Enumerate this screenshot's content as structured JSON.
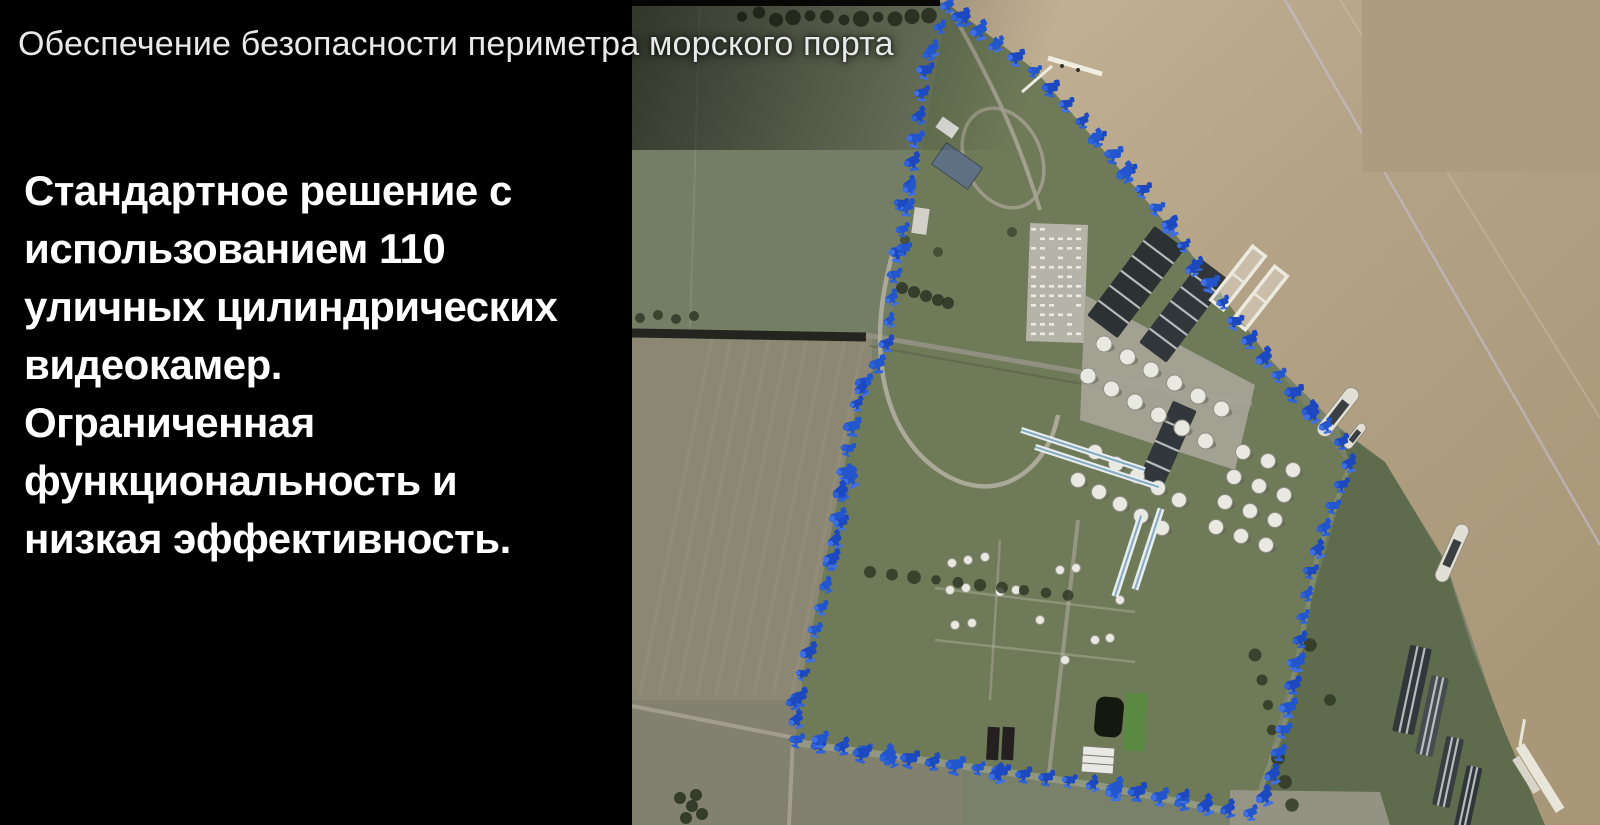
{
  "slide": {
    "title": "Обеспечение безопасности периметра морского порта",
    "body": "Стандартное решение с\nиспользованием 110\nуличных цилиндрических\nвидеокамер.\nОграниченная\nфункциональность и\nнизкая эффективность."
  },
  "map": {
    "type": "satellite-aerial-view",
    "subject": "seaport-industrial-facility-with-camera-perimeter",
    "perimeter": {
      "marker_icon": "cctv-camera-icon",
      "marker_color_dark": "#1c49c0",
      "marker_color_light": "#3f6fe0",
      "spacing_px": 23,
      "points": [
        [
          948,
          4
        ],
        [
          926,
          68
        ],
        [
          916,
          138
        ],
        [
          906,
          212
        ],
        [
          894,
          280
        ],
        [
          886,
          352
        ],
        [
          860,
          388
        ],
        [
          846,
          462
        ],
        [
          836,
          535
        ],
        [
          822,
          606
        ],
        [
          803,
          674
        ],
        [
          796,
          722
        ],
        [
          794,
          738
        ],
        [
          806,
          742
        ],
        [
          850,
          746
        ],
        [
          900,
          756
        ],
        [
          950,
          763
        ],
        [
          1013,
          772
        ],
        [
          1073,
          780
        ],
        [
          1127,
          788
        ],
        [
          1180,
          800
        ],
        [
          1230,
          808
        ],
        [
          1253,
          812
        ],
        [
          1262,
          802
        ],
        [
          1277,
          763
        ],
        [
          1287,
          716
        ],
        [
          1297,
          668
        ],
        [
          1303,
          620
        ],
        [
          1311,
          571
        ],
        [
          1324,
          528
        ],
        [
          1340,
          490
        ],
        [
          1350,
          464
        ],
        [
          1341,
          437
        ],
        [
          1318,
          418
        ],
        [
          1302,
          400
        ],
        [
          1268,
          361
        ],
        [
          1236,
          321
        ],
        [
          1205,
          273
        ],
        [
          1168,
          222
        ],
        [
          1130,
          170
        ],
        [
          1085,
          122
        ],
        [
          1035,
          70
        ],
        [
          988,
          35
        ],
        [
          950,
          8
        ]
      ]
    },
    "colors": {
      "background": "#000000",
      "water": "#b3a286",
      "water_light": "#c2b194",
      "field": "#79816a",
      "field_plowed": "#8b8773",
      "facility_pad": "#a7a599",
      "overlay_patch": "#ae9c80",
      "title_text": "#e9e9e9",
      "body_text": "#ffffff"
    }
  }
}
